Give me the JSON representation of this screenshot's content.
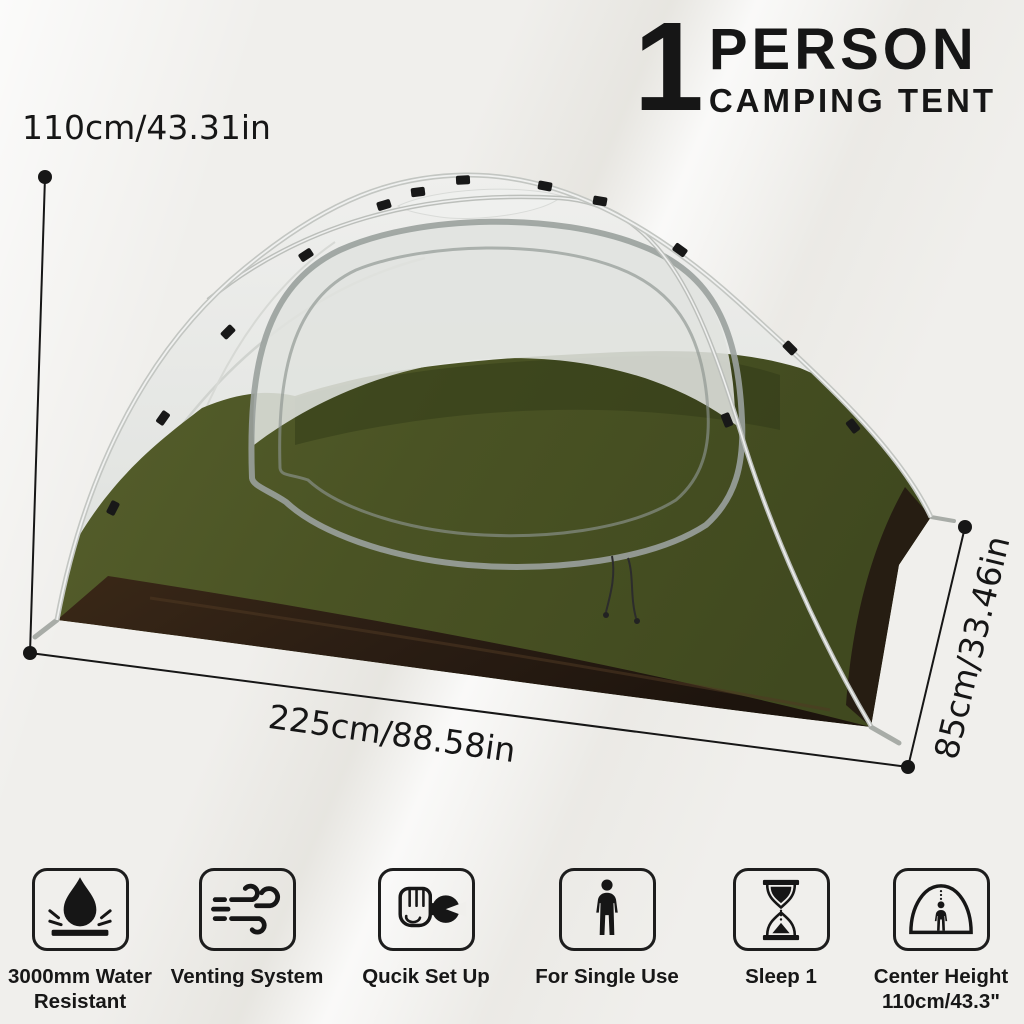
{
  "title": {
    "count": "1",
    "word": "PERSON",
    "subtitle": "CAMPING TENT"
  },
  "dimensions": {
    "height": "110cm/43.31in",
    "width": "225cm/88.58in",
    "depth": "85cm/33.46in"
  },
  "features": [
    {
      "icon": "water-resistant-icon",
      "lines": [
        "3000mm Water",
        "Resistant"
      ]
    },
    {
      "icon": "venting-system-icon",
      "lines": [
        "Venting System"
      ]
    },
    {
      "icon": "quick-set-up-icon",
      "lines": [
        "Qucik Set Up"
      ]
    },
    {
      "icon": "single-use-icon",
      "lines": [
        "For Single Use"
      ]
    },
    {
      "icon": "sleep-capacity-icon",
      "lines": [
        "Sleep 1"
      ]
    },
    {
      "icon": "center-height-icon",
      "lines": [
        "Center Height",
        "110cm/43.3\""
      ]
    }
  ],
  "colors": {
    "ink": "#161616",
    "tent_green": "#4a5324",
    "tent_green_dark": "#39431c",
    "tent_brown": "#2a1d13",
    "mesh": "#e7e8e5",
    "mesh_shade": "#cdd2cc",
    "pole": "#c3c6c2",
    "background": "#f0efec"
  }
}
